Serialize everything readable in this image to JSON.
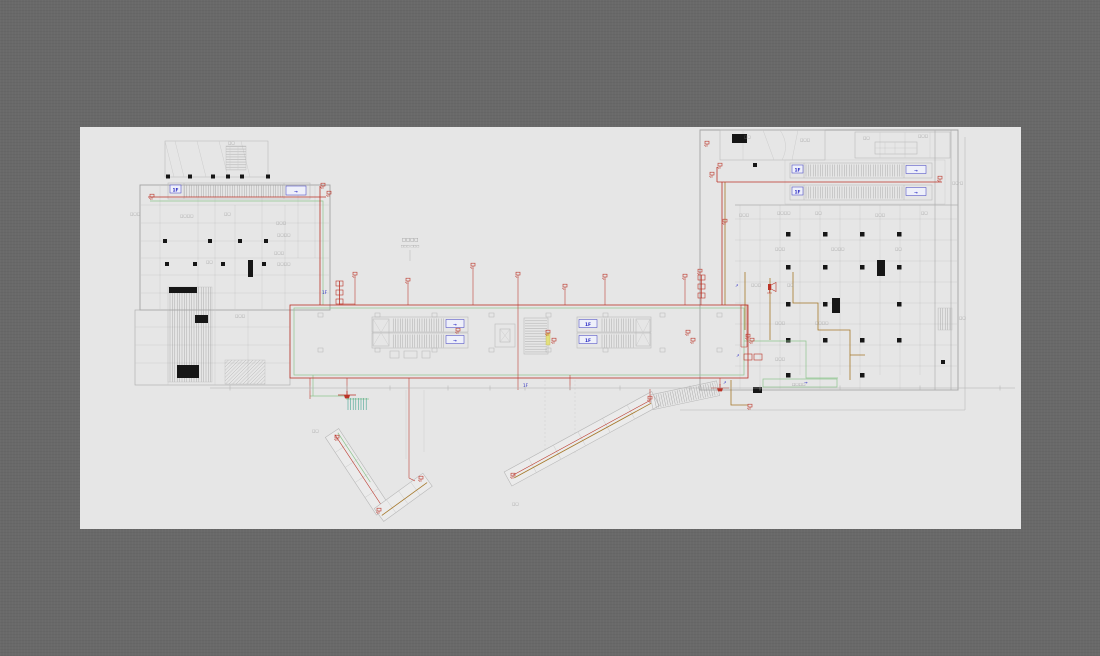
{
  "window": {
    "background_color": "#696969",
    "canvas_color": "#e6e6e6"
  },
  "colors": {
    "red_wiring": "#bb3327",
    "green_wiring": "#8ec58e",
    "orange_cable": "#a5782a",
    "teal_bundle": "#3aa08c",
    "blue_annotation": "#2b2bc4",
    "structure_black": "#161616",
    "wall_gray": "#a3a3a3",
    "line_gray": "#c9c9c9",
    "label_gray": "#8d8d8d",
    "highlight_yellow": "#e3df7d"
  },
  "title": {
    "l1": "□□□□",
    "l2": "□□□ □□□"
  },
  "tags": {
    "floor": "1F",
    "dir": "→"
  },
  "marks": {
    "a": "↗",
    "b": "→"
  },
  "tiny": [
    "□□□",
    "□□□□",
    "□□",
    "□□□",
    "□□□□",
    "□□□",
    "□□□□",
    "□□",
    "□□",
    "□□□",
    "□□",
    "□□",
    "□□·□",
    "□□",
    "□□□",
    "□□",
    "□□□",
    "□□□",
    "□□□□",
    "□□",
    "□□□",
    "□□",
    "□□□",
    "□□□□",
    "□□",
    "□□□",
    "□□",
    "□□□",
    "□□□□",
    "□□□",
    "□□□□",
    "□□"
  ]
}
